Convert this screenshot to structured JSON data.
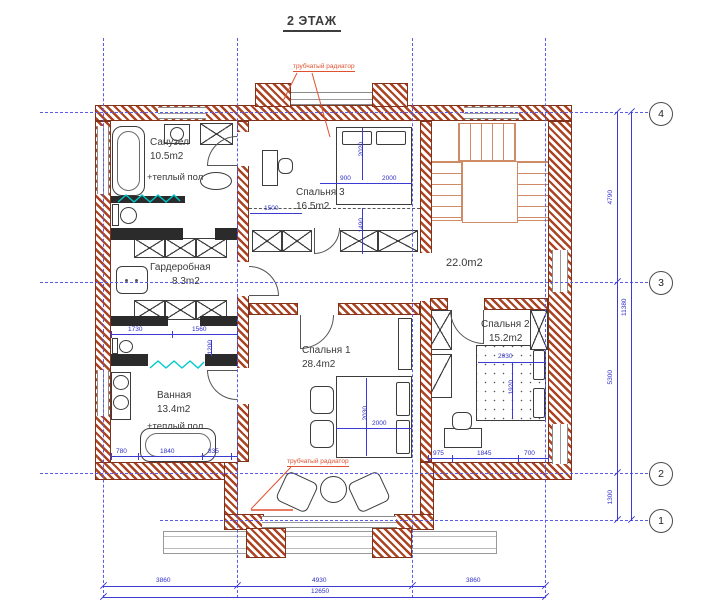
{
  "title": "2 ЭТАЖ",
  "annotations": {
    "radiator_top": "трубчатый радиатор",
    "radiator_bottom": "трубчатый радиатор"
  },
  "rooms": {
    "sanuzel": {
      "name": "Санузел",
      "area": "10.5m2",
      "note": "+теплый пол"
    },
    "garderobnaya": {
      "name": "Гардеробная",
      "area": "8.3m2"
    },
    "vannaya": {
      "name": "Ванная",
      "area": "13.4m2",
      "note": "+теплый пол"
    },
    "spalnya3": {
      "name": "Спальня 3",
      "area": "16.5m2"
    },
    "spalnya1": {
      "name": "Спальня 1",
      "area": "28.4m2"
    },
    "spalnya2": {
      "name": "Спальня 2",
      "area": "15.2m2"
    },
    "hall": {
      "area": "22.0m2"
    }
  },
  "axis_markers": [
    "4",
    "3",
    "2",
    "1"
  ],
  "dims": {
    "bottom_segments": [
      "3860",
      "4930",
      "3860"
    ],
    "bottom_total": "12650",
    "right_segments": [
      "4790",
      "5300",
      "1300"
    ],
    "right_total": "11380",
    "wardrobe_widths": [
      "1730",
      "1560"
    ],
    "bath_widths": [
      "780",
      "1840",
      "835"
    ],
    "bath_height": "1200",
    "bedroom2_widths": [
      "975",
      "1845",
      "700"
    ],
    "bed1_length": "2030",
    "bed1_width": "2000",
    "bed3_offset": "900",
    "bed3_width": "2000",
    "bed3_length": "2020",
    "bedroom3_left": "1500",
    "bedroom3_vert": "1490",
    "bed2_width": "2030",
    "bed2_length": "1920"
  },
  "colors": {
    "wall_brick": "#ab4422",
    "dimension_blue": "#3b3bd4",
    "annotation_red": "#e0512f",
    "glass_teal": "#00c9c9",
    "stair_salmon": "#cf8a66"
  }
}
